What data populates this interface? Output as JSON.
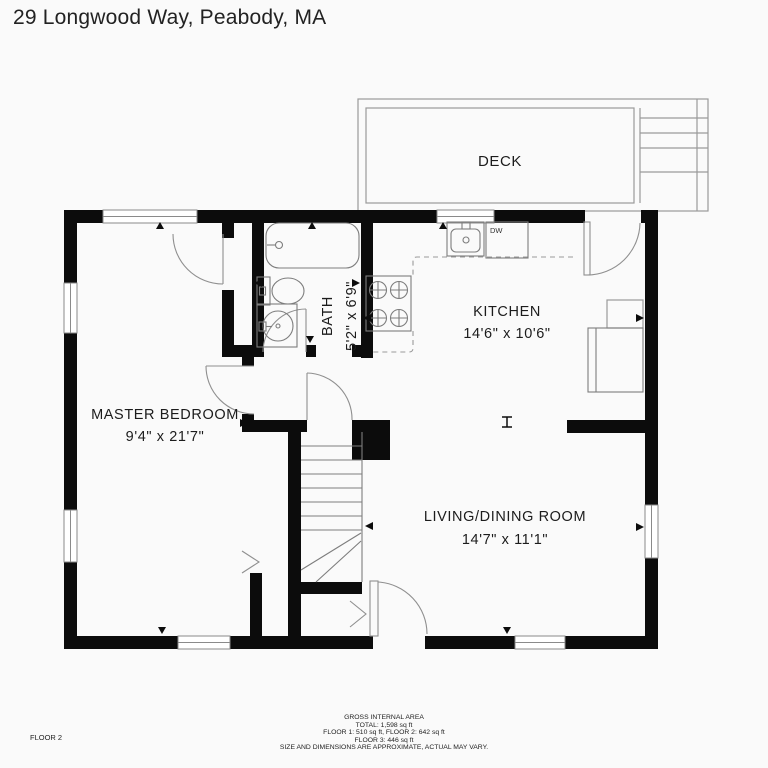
{
  "title": "29 Longwood Way, Peabody, MA",
  "floor_label": "FLOOR 2",
  "rooms": {
    "deck": {
      "name": "DECK"
    },
    "kitchen": {
      "name": "KITCHEN",
      "dimensions": "14'6\" x 10'6\""
    },
    "bath": {
      "name": "BATH",
      "dimensions": "5'2\" x 6'9\""
    },
    "master_bedroom": {
      "name": "MASTER BEDROOM",
      "dimensions": "9'4\" x 21'7\""
    },
    "living_dining": {
      "name": "LIVING/DINING ROOM",
      "dimensions": "14'7\" x 11'1\""
    }
  },
  "appliances": {
    "dishwasher_label": "DW"
  },
  "footer": {
    "line1": "GROSS INTERNAL AREA",
    "line2": "TOTAL: 1,598 sq ft",
    "line3": "FLOOR 1: 510 sq ft, FLOOR 2: 642 sq ft",
    "line4": "FLOOR 3: 446 sq ft",
    "line5": "SIZE AND DIMENSIONS ARE APPROXIMATE, ACTUAL MAY VARY."
  },
  "colors": {
    "wall": "#0c0c0c",
    "line": "#9a9a9a",
    "text": "#1c1c1c",
    "background": "#fafafa"
  }
}
